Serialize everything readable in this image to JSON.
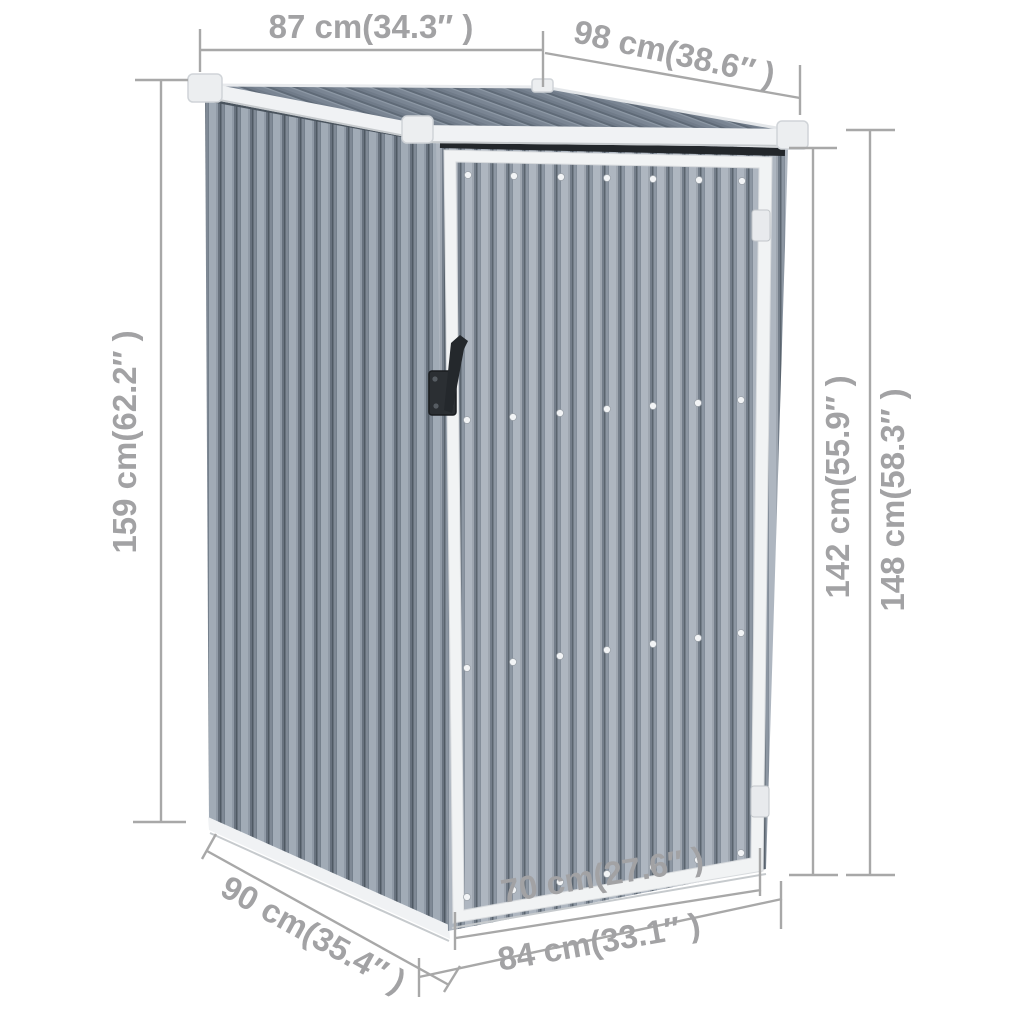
{
  "diagram": {
    "type": "product-dimension-diagram",
    "subject": "metal garden shed with pent roof and single door",
    "background_color": "#ffffff",
    "dimension_color": "#a8a8a8",
    "shed_colors": {
      "wall": "#9aa4b0",
      "roof": "#7a8593",
      "trim": "#f0f2f4",
      "door_panel": "#aeb6c0",
      "handle": "#262a2e"
    },
    "labels": {
      "roof_back_width": "87 cm(34.3″ )",
      "roof_slope_depth": "98 cm(38.6″ )",
      "back_height": "159 cm(62.2″ )",
      "door_height": "142 cm(55.9″ )",
      "front_height": "148 cm(58.3″ )",
      "side_depth": "90 cm(35.4″ )",
      "door_width": "70 cm(27.6″ )",
      "front_width": "84 cm(33.1″ )"
    }
  }
}
